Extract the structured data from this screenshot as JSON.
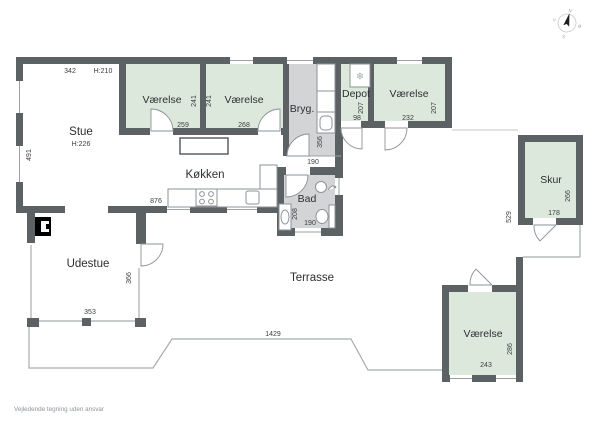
{
  "footer": "Vejledende tegning uden ansvar",
  "compass": {
    "north": "N",
    "east": "Ø",
    "south": "S",
    "west": "V"
  },
  "colors": {
    "wall": "#5c6164",
    "room_fill": "#dde8dd",
    "wet_room_fill": "#d3d4d6",
    "fixture_line": "#8e9397",
    "window_line": "#9ba1a5",
    "terrace_line": "#a8acae",
    "label_text": "#2c2f31",
    "footer_text": "#8f9498"
  },
  "rooms": {
    "stue": {
      "label": "Stue",
      "ceiling_height": "H:226",
      "top_width": "342",
      "top_ceiling_height": "H:210",
      "left_height": "491"
    },
    "vaerelse_nw": {
      "label": "Værelse",
      "width": "259",
      "depth": "241"
    },
    "vaerelse_n": {
      "label": "Værelse",
      "width": "268",
      "depth": "241"
    },
    "bryggers": {
      "label": "Bryg.",
      "depth": "356",
      "door_width": "190"
    },
    "depot": {
      "label": "Depot",
      "depth": "207",
      "width": "98"
    },
    "vaerelse_ne": {
      "label": "Værelse",
      "depth": "207",
      "width": "232"
    },
    "koekken": {
      "label": "Køkken",
      "counter_width": "876"
    },
    "bad": {
      "label": "Bad",
      "depth": "208",
      "door_width": "190"
    },
    "udestue": {
      "label": "Udestue",
      "depth": "366",
      "width": "353"
    },
    "terrasse": {
      "label": "Terrasse",
      "front_width": "1429",
      "east_depth": "529"
    },
    "skur": {
      "label": "Skur",
      "depth": "266",
      "width": "178"
    },
    "vaerelse_s": {
      "label": "Værelse",
      "depth": "286",
      "width": "243"
    }
  }
}
